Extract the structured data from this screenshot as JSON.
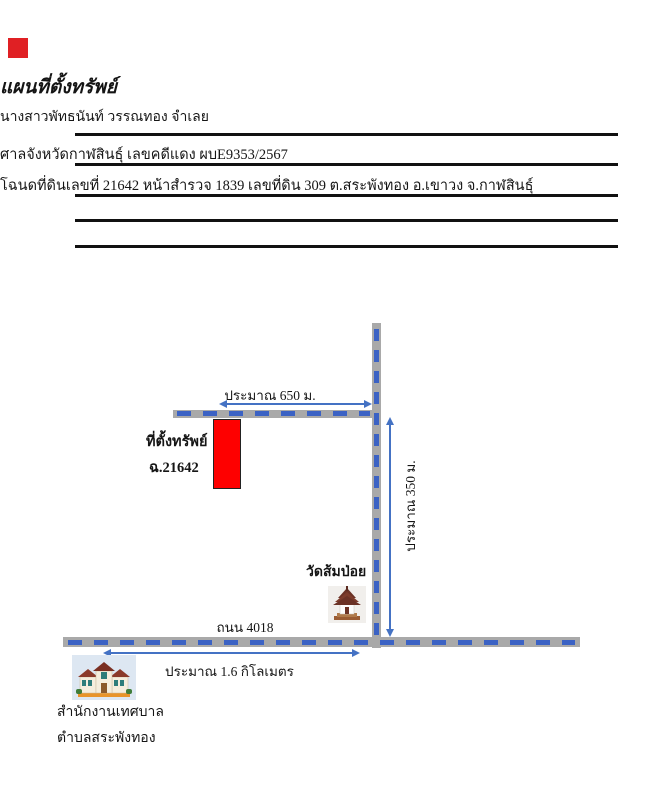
{
  "page": {
    "marker_color": "#e02024"
  },
  "header": {
    "title": "แผนที่ตั้งทรัพย์",
    "defendant_line": "นางสาวพัทธนันท์ วรรณทอง  จำเลย",
    "court_line": "ศาลจังหวัดกาฬสินธุ์ เลขคดีแดง ผบE9353/2567",
    "deed_line": "โฉนดที่ดินเลขที่  21642 หน้าสำรวจ 1839 เลขที่ดิน 309 ต.สระพังทอง อ.เขาวง จ.กาฬสินธุ์"
  },
  "map": {
    "labels": {
      "top_distance": "ประมาณ 650 ม.",
      "property_name": "ที่ตั้งทรัพย์",
      "property_deed": "ฉ.21642",
      "side_distance": "ประมาณ  350 ม.",
      "temple": "วัดส้มป่อย",
      "road_name": "ถนน 4018",
      "bottom_distance": "ประมาณ 1.6 กิโลเมตร",
      "office_line1": "สำนักงานเทศบาล",
      "office_line2": "ตำบลสระพังทอง"
    },
    "colors": {
      "road": "#a9a9a9",
      "dash": "#3b62c4",
      "arrow": "#4472c4",
      "property_fill": "#fe0000"
    }
  }
}
